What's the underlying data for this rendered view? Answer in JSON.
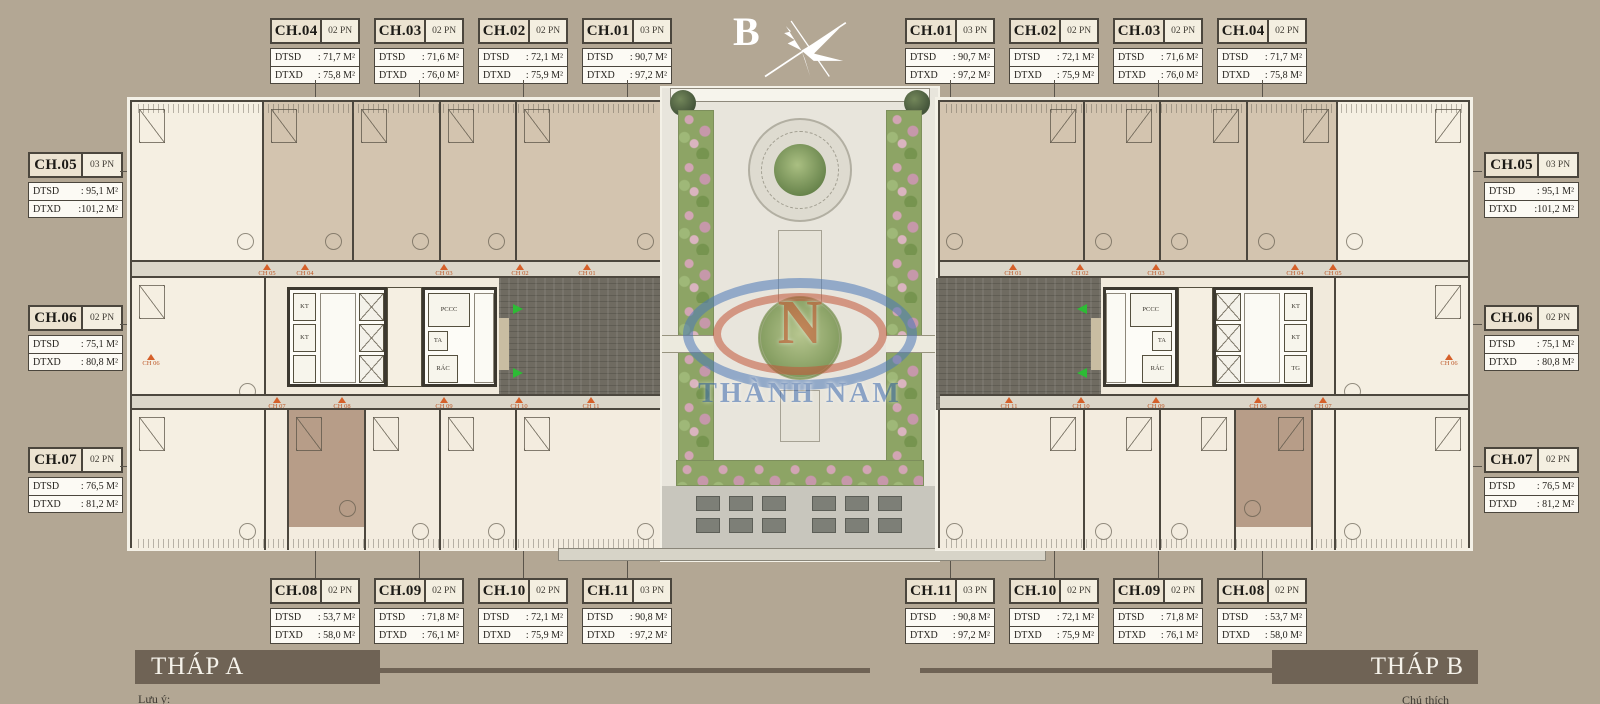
{
  "page": {
    "background_color": "#b3a794"
  },
  "compass": {
    "label": "B"
  },
  "watermark": {
    "initial": "N",
    "name": "THÀNH NAM"
  },
  "field_labels": {
    "dtsd": "DTSD",
    "dtxd": "DTXD"
  },
  "unit_groups": {
    "top_left": [
      {
        "id": "CH.04",
        "pn": "02 PN",
        "dtsd": ": 71,7 M²",
        "dtxd": ": 75,8 M²"
      },
      {
        "id": "CH.03",
        "pn": "02 PN",
        "dtsd": ": 71,6 M²",
        "dtxd": ": 76,0 M²"
      },
      {
        "id": "CH.02",
        "pn": "02 PN",
        "dtsd": ": 72,1 M²",
        "dtxd": ": 75,9 M²"
      },
      {
        "id": "CH.01",
        "pn": "03 PN",
        "dtsd": ": 90,7 M²",
        "dtxd": ": 97,2 M²"
      }
    ],
    "top_right": [
      {
        "id": "CH.01",
        "pn": "03 PN",
        "dtsd": ": 90,7 M²",
        "dtxd": ": 97,2 M²"
      },
      {
        "id": "CH.02",
        "pn": "02 PN",
        "dtsd": ": 72,1 M²",
        "dtxd": ": 75,9 M²"
      },
      {
        "id": "CH.03",
        "pn": "02 PN",
        "dtsd": ": 71,6 M²",
        "dtxd": ": 76,0 M²"
      },
      {
        "id": "CH.04",
        "pn": "02 PN",
        "dtsd": ": 71,7 M²",
        "dtxd": ": 75,8 M²"
      }
    ],
    "side_left": [
      {
        "id": "CH.05",
        "pn": "03 PN",
        "dtsd": ": 95,1 M²",
        "dtxd": ":101,2 M²"
      },
      {
        "id": "CH.06",
        "pn": "02 PN",
        "dtsd": ": 75,1 M²",
        "dtxd": ": 80,8 M²"
      },
      {
        "id": "CH.07",
        "pn": "02 PN",
        "dtsd": ": 76,5 M²",
        "dtxd": ": 81,2 M²"
      }
    ],
    "side_right": [
      {
        "id": "CH.05",
        "pn": "03 PN",
        "dtsd": ": 95,1 M²",
        "dtxd": ":101,2 M²"
      },
      {
        "id": "CH.06",
        "pn": "02 PN",
        "dtsd": ": 75,1 M²",
        "dtxd": ": 80,8 M²"
      },
      {
        "id": "CH.07",
        "pn": "02 PN",
        "dtsd": ": 76,5 M²",
        "dtxd": ": 81,2 M²"
      }
    ],
    "bottom_left": [
      {
        "id": "CH.08",
        "pn": "02 PN",
        "dtsd": ": 53,7 M²",
        "dtxd": ": 58,0 M²"
      },
      {
        "id": "CH.09",
        "pn": "02 PN",
        "dtsd": ": 71,8 M²",
        "dtxd": ": 76,1 M²"
      },
      {
        "id": "CH.10",
        "pn": "02 PN",
        "dtsd": ": 72,1 M²",
        "dtxd": ": 75,9 M²"
      },
      {
        "id": "CH.11",
        "pn": "03 PN",
        "dtsd": ": 90,8 M²",
        "dtxd": ": 97,2 M²"
      }
    ],
    "bottom_right": [
      {
        "id": "CH.11",
        "pn": "03 PN",
        "dtsd": ": 90,8 M²",
        "dtxd": ": 97,2 M²"
      },
      {
        "id": "CH.10",
        "pn": "02 PN",
        "dtsd": ": 72,1 M²",
        "dtxd": ": 75,9 M²"
      },
      {
        "id": "CH.09",
        "pn": "02 PN",
        "dtsd": ": 71,8 M²",
        "dtxd": ": 76,1 M²"
      },
      {
        "id": "CH.08",
        "pn": "02 PN",
        "dtsd": ": 53,7 M²",
        "dtxd": ": 58,0 M²"
      }
    ]
  },
  "plan": {
    "core_labels": {
      "kt": "KT",
      "pccc": "PCCC",
      "ta": "TA",
      "rac": "RÁC",
      "tg": "TG"
    },
    "corridor_markers_top": [
      "CH 05",
      "CH 04",
      "CH 03",
      "CH 02",
      "CH 01"
    ],
    "corridor_markers_bottom": [
      "CH 07",
      "CH 08",
      "CH 09",
      "CH 10",
      "CH 11"
    ],
    "side_marker": "CH 06"
  },
  "footer": {
    "tower_a_label": "THÁP A",
    "tower_b_label": "THÁP B",
    "note_left": "Lưu ý:",
    "note_right": "Chú thích"
  }
}
